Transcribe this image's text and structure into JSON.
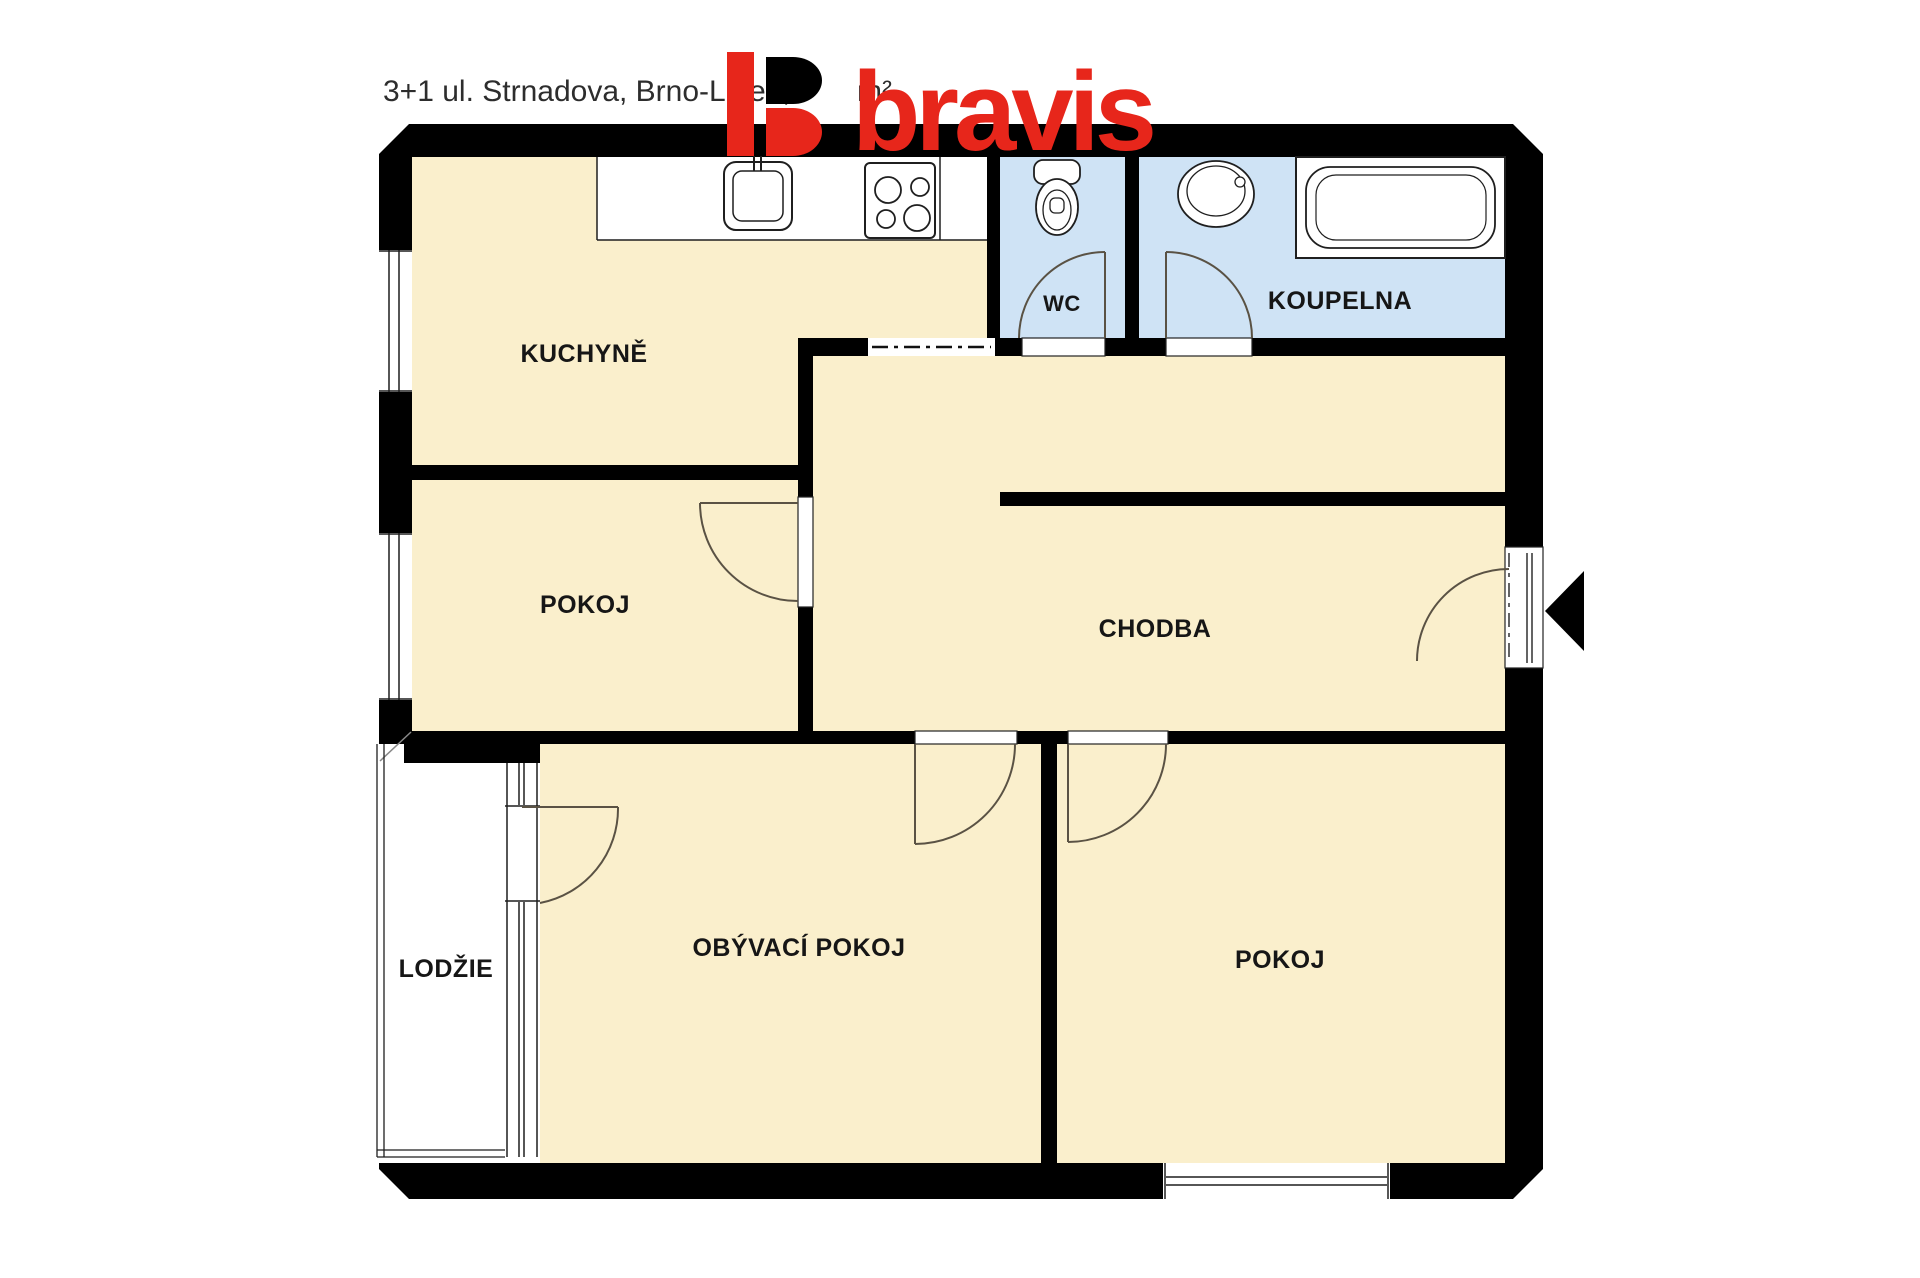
{
  "colors": {
    "wall": "#000000",
    "room": "#faefcc",
    "wet": "#cfe3f5",
    "line": "#1f1f1f",
    "door": "#5a5244",
    "logo_red": "#e7261b",
    "title": "#2d2d2d",
    "label": "#161616"
  },
  "header": {
    "title_left": "3+1 ul. Strnadova, Brno-Líšeň,",
    "title_right": "m²"
  },
  "logo": {
    "wordmark": "bravis"
  },
  "rooms": {
    "kitchen": {
      "label": "KUCHYNĚ"
    },
    "wc": {
      "label": "WC"
    },
    "bathroom": {
      "label": "KOUPELNA"
    },
    "room_left": {
      "label": "POKOJ"
    },
    "hallway": {
      "label": "CHODBA"
    },
    "living_room": {
      "label": "OBÝVACÍ POKOJ"
    },
    "room_right": {
      "label": "POKOJ"
    },
    "loggia": {
      "label": "LODŽIE"
    }
  }
}
